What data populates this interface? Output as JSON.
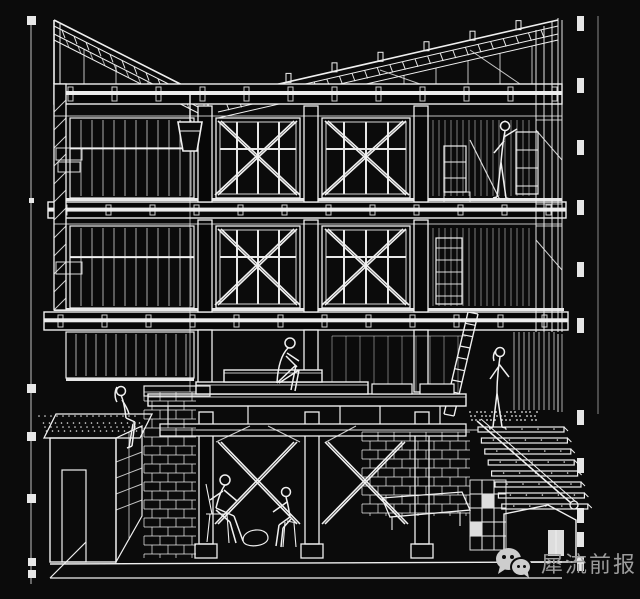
{
  "canvas": {
    "width": 640,
    "height": 599,
    "background": "#0b0b0b",
    "ink": "#f0f0f0"
  },
  "drawing": {
    "type": "architectural sectional perspective",
    "style": "white wireframe line art on black background",
    "levels": [
      {
        "name": "roof",
        "features": [
          "two opposing sloped truss rafters with hatch marks",
          "clerestory hanger posts",
          "hanging pulley bucket with plumb line"
        ]
      },
      {
        "name": "third-floor",
        "features": [
          "glazed bays with mullions",
          "X cross-bracing in two bays",
          "standing figure at shelving unit"
        ]
      },
      {
        "name": "second-floor",
        "features": [
          "glazed bays with mullions",
          "X cross-bracing in two bays",
          "shelf ladder unit"
        ]
      },
      {
        "name": "ground-floor",
        "features": [
          "stepped timber stage platform",
          "seated figure on stage",
          "leaning ladder",
          "standing figure on gravel strip",
          "annex box with pebble roof and seated figure",
          "brick pier"
        ]
      },
      {
        "name": "basement",
        "features": [
          "brick retaining walls",
          "X cross-bracing",
          "two seated figures with chairs",
          "column plinths",
          "descending stair with handrail knob",
          "box volume with white door"
        ]
      }
    ],
    "figures_count": 6,
    "guides": {
      "left_guide": "thin vertical line with square tick markers",
      "right_section_line": "bold dashed vertical section line",
      "right_reference_line": "thin vertical reference line"
    }
  },
  "watermark": {
    "icon": "wechat-icon",
    "text": "犀流前报",
    "color": "#9c9c9c",
    "icon_color": "#cdcdcd"
  }
}
